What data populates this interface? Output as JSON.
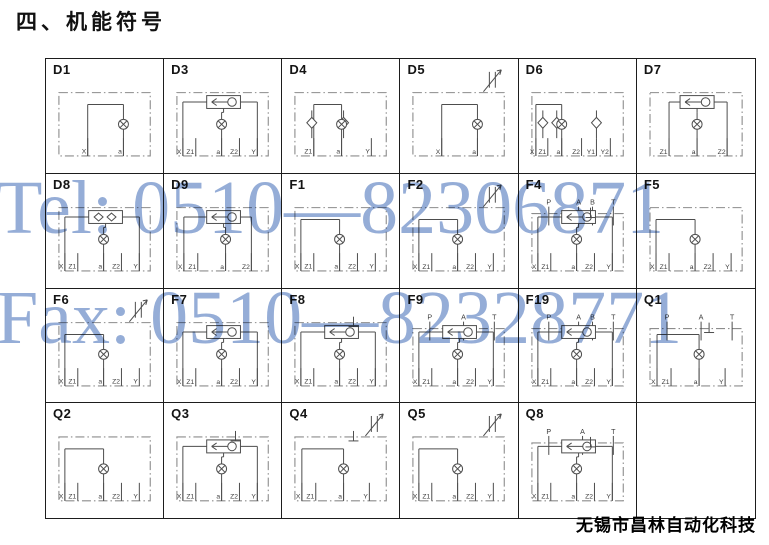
{
  "page": {
    "title": "四、机能符号",
    "company": "无锡市昌林自动化科技"
  },
  "watermark": {
    "tel": "Tel: 0510—82306871",
    "fax": "Fax: 0510—82328771",
    "color": "#7e9bce"
  },
  "colors": {
    "grid_border": "#1d1d1d",
    "schematic_line": "#4d4d4d",
    "dash_box": "#8c8c8c",
    "port_label": "#3d3d3d"
  },
  "grid": {
    "rows": 4,
    "cols": 6
  },
  "cells": [
    {
      "id": "D1",
      "top": [],
      "bottom": [
        "X",
        "a"
      ],
      "features": [
        "pilot"
      ]
    },
    {
      "id": "D3",
      "top": [],
      "bottom": [
        "X",
        "Z1",
        "a",
        "Z2",
        "Y"
      ],
      "features": [
        "shuttle",
        "pilot"
      ]
    },
    {
      "id": "D4",
      "top": [],
      "bottom": [
        "Z1",
        "a",
        "Y"
      ],
      "features": [
        "check",
        "check",
        "pilot"
      ]
    },
    {
      "id": "D5",
      "top": [],
      "bottom": [
        "X",
        "a"
      ],
      "features": [
        "throttle",
        "pilot"
      ]
    },
    {
      "id": "D6",
      "top": [],
      "bottom": [
        "X",
        "Z1",
        "a",
        "Z2",
        "Y1",
        "Y2"
      ],
      "features": [
        "check",
        "check",
        "check",
        "pilot"
      ]
    },
    {
      "id": "D7",
      "top": [],
      "bottom": [
        "Z1",
        "a",
        "Z2"
      ],
      "features": [
        "shuttle",
        "pilot"
      ]
    },
    {
      "id": "D8",
      "top": [],
      "bottom": [
        "X",
        "Z1",
        "a",
        "Z2",
        "Y"
      ],
      "features": [
        "dualvalve",
        "pilot"
      ]
    },
    {
      "id": "D9",
      "top": [],
      "bottom": [
        "X",
        "Z1",
        "a",
        "Z2"
      ],
      "features": [
        "shuttle",
        "pilot"
      ]
    },
    {
      "id": "F1",
      "top": [],
      "bottom": [
        "X",
        "Z1",
        "a",
        "Z2",
        "Y"
      ],
      "features": [
        "pilot"
      ]
    },
    {
      "id": "F2",
      "top": [],
      "bottom": [
        "X",
        "Z1",
        "a",
        "Z2",
        "Y"
      ],
      "features": [
        "throttle",
        "pilot"
      ]
    },
    {
      "id": "F4",
      "top": [
        "P",
        "A",
        "B",
        "T"
      ],
      "bottom": [
        "X",
        "Z1",
        "a",
        "Z2",
        "Y"
      ],
      "features": [
        "shuttle",
        "pilot",
        "vent"
      ]
    },
    {
      "id": "F5",
      "top": [],
      "bottom": [
        "X",
        "Z1",
        "a",
        "Z2",
        "Y"
      ],
      "features": [
        "pilot"
      ]
    },
    {
      "id": "F6",
      "top": [],
      "bottom": [
        "X",
        "Z1",
        "a",
        "Z2",
        "Y"
      ],
      "features": [
        "throttle",
        "pilot"
      ]
    },
    {
      "id": "F7",
      "top": [],
      "bottom": [
        "X",
        "Z1",
        "a",
        "Z2",
        "Y"
      ],
      "features": [
        "shuttle",
        "pilot"
      ]
    },
    {
      "id": "F8",
      "top": [],
      "bottom": [
        "X",
        "Z1",
        "a",
        "Z2",
        "Y"
      ],
      "features": [
        "shuttle",
        "pilot",
        "vent"
      ]
    },
    {
      "id": "F9",
      "top": [
        "P",
        "A",
        "T"
      ],
      "bottom": [
        "X",
        "Z1",
        "a",
        "Z2",
        "Y"
      ],
      "features": [
        "shuttle",
        "pilot"
      ]
    },
    {
      "id": "F19",
      "top": [
        "P",
        "A",
        "B",
        "T"
      ],
      "bottom": [
        "X",
        "Z1",
        "a",
        "Z2",
        "Y"
      ],
      "features": [
        "shuttle",
        "pilot"
      ]
    },
    {
      "id": "Q1",
      "top": [
        "P",
        "A",
        "T"
      ],
      "bottom": [
        "X",
        "Z1",
        "a",
        "Y"
      ],
      "features": [
        "pilot",
        "vent"
      ]
    },
    {
      "id": "Q2",
      "top": [],
      "bottom": [
        "X",
        "Z1",
        "a",
        "Z2",
        "Y"
      ],
      "features": [
        "pilot"
      ]
    },
    {
      "id": "Q3",
      "top": [],
      "bottom": [
        "X",
        "Z1",
        "a",
        "Z2",
        "Y"
      ],
      "features": [
        "shuttle",
        "pilot",
        "vent"
      ]
    },
    {
      "id": "Q4",
      "top": [],
      "bottom": [
        "X",
        "Z1",
        "a",
        "Y"
      ],
      "features": [
        "throttle",
        "pilot",
        "vent"
      ]
    },
    {
      "id": "Q5",
      "top": [],
      "bottom": [
        "X",
        "Z1",
        "a",
        "Z2",
        "Y"
      ],
      "features": [
        "throttle",
        "pilot"
      ]
    },
    {
      "id": "Q8",
      "top": [
        "P",
        "A",
        "T"
      ],
      "bottom": [
        "X",
        "Z1",
        "a",
        "Z2",
        "Y"
      ],
      "features": [
        "shuttle",
        "pilot",
        "vent"
      ]
    },
    {
      "id": "",
      "top": [],
      "bottom": [],
      "features": []
    }
  ]
}
